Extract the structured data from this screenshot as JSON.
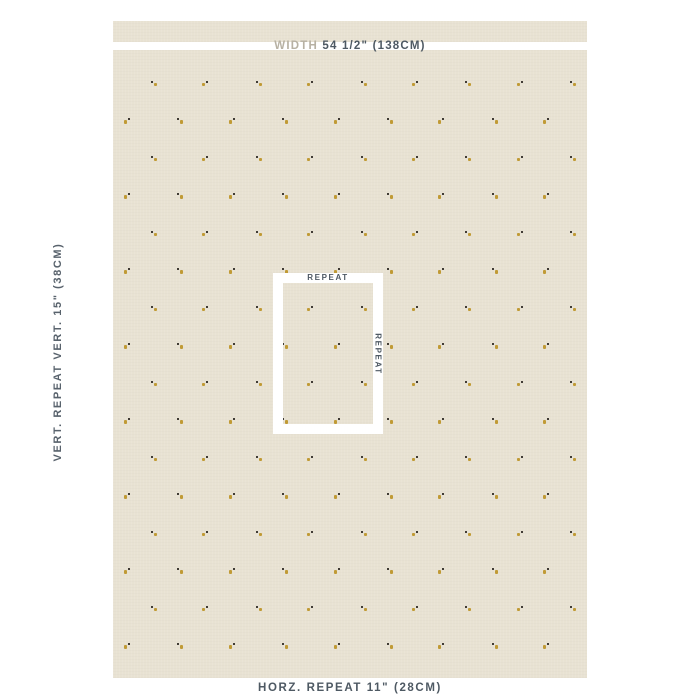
{
  "swatch": {
    "fabric_color": "#e9e3d4",
    "band_color": "#ffffff",
    "description": "beige linen fabric swatch with scattered tiny bee-seed motifs"
  },
  "labels": {
    "width_prefix": "WIDTH",
    "width_value": "54 1/2\" (138CM)",
    "vertical_repeat": "VERT. REPEAT VERT. 15\" (38CM)",
    "horizontal_repeat": "HORZ. REPEAT 11\" (28CM)",
    "repeat_top": "REPEAT",
    "repeat_side": "REPEAT"
  },
  "colors": {
    "label_dark": "#4e5963",
    "label_light": "#b7b1a3",
    "motif_gold": "#c09a35",
    "motif_dark": "#35302a"
  },
  "pattern": {
    "type": "half-drop grid",
    "row_start_y": 45,
    "row_spacing": 37.5,
    "row_count": 17,
    "col_spacing": 52.4,
    "col_count": 9,
    "even_row_x_start": 127,
    "odd_row_x_start": 153,
    "fabric_left": 113,
    "fabric_top": 21
  }
}
